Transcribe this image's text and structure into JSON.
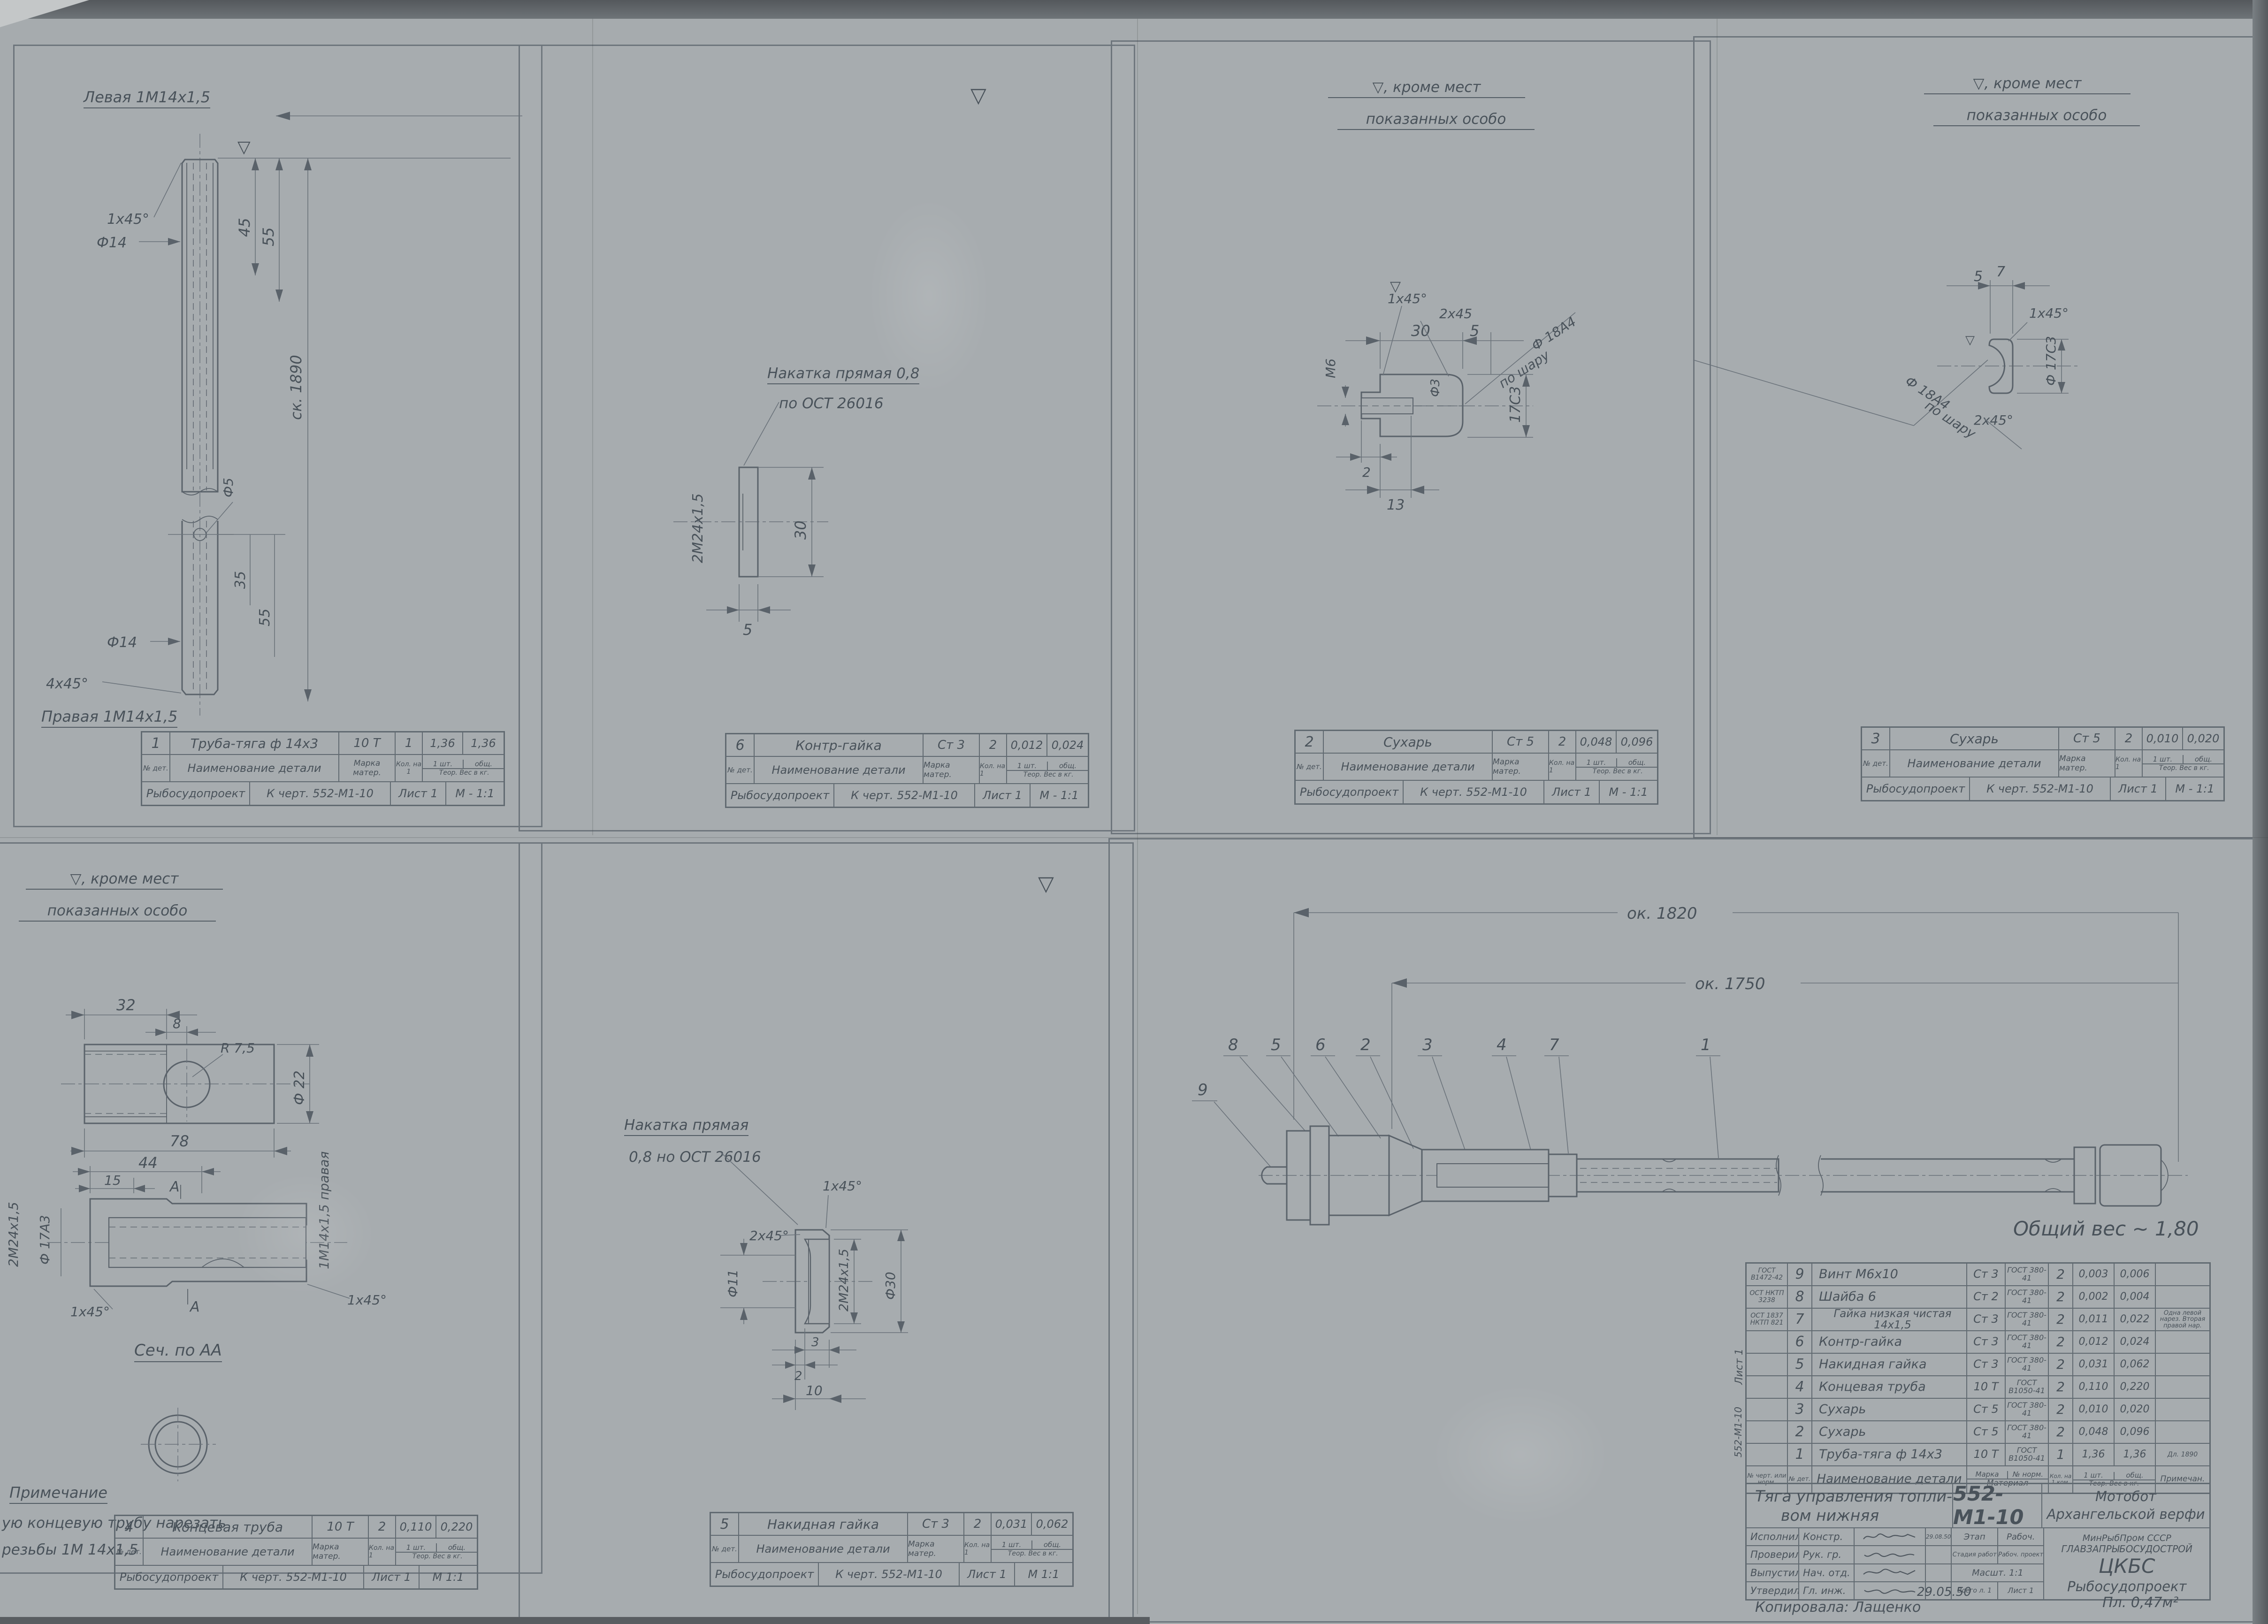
{
  "common": {
    "finish_note_line1": "▽, кроме мест",
    "finish_note_line2": "показанных особо",
    "finish_mark": "▽",
    "mini_labels": {
      "no_det": "№ дет.",
      "name": "Наименование детали",
      "marka": "Марка матер.",
      "qty": "Кол. на 1",
      "w1": "1 шт.",
      "wtot": "общ.",
      "weight": "Теор. Вес в кг.",
      "org": "Рыбосудопроект",
      "chert": "К черт. 552-М1-10",
      "list": "Лист 1"
    }
  },
  "panel1": {
    "top_label": "Левая 1М14х1,5",
    "bottom_label": "Правая 1М14х1,5",
    "dims": {
      "chamfer_top": "1х45°",
      "d14": "Ф14",
      "d5": "Ф5",
      "len45": "45",
      "len55": "55",
      "total": "ск. 1890",
      "d14b": "Ф14",
      "len35": "35",
      "len55b": "55",
      "chamfer_bottom": "4х45°"
    },
    "block": {
      "num": "1",
      "name": "Труба-тяга ф 14х3",
      "mat": "10 Т",
      "qty": "1",
      "w1": "1,36",
      "wt": "1,36",
      "scale": "М - 1:1"
    }
  },
  "panel2": {
    "note1": "Накатка прямая 0,8",
    "note2": "по ОСТ 26016",
    "dims": {
      "thread": "2М24х1,5",
      "h": "30",
      "w": "5"
    },
    "block": {
      "num": "6",
      "name": "Контр-гайка",
      "mat": "Ст 3",
      "qty": "2",
      "w1": "0,012",
      "wt": "0,024",
      "scale": "М - 1:1"
    }
  },
  "panel3": {
    "dims": {
      "w30": "30",
      "w5": "5",
      "ch2": "2х45",
      "ch1": "1х45°",
      "m6": "М6",
      "d3": "Ф3",
      "sphere": "по шару",
      "d18": "Ф 18А4",
      "d17": "17С3",
      "t2": "2",
      "t13": "13"
    },
    "block": {
      "num": "2",
      "name": "Сухарь",
      "mat": "Ст 5",
      "qty": "2",
      "w1": "0,048",
      "wt": "0,096",
      "scale": "М - 1:1"
    }
  },
  "panel4": {
    "dims": {
      "w5": "5",
      "w7": "7",
      "ch1": "1х45°",
      "d18": "Ф 18А4",
      "sphere": "по шару",
      "ch2": "2х45°",
      "d17": "Ф 17С3"
    },
    "block": {
      "num": "3",
      "name": "Сухарь",
      "mat": "Ст 5",
      "qty": "2",
      "w1": "0,010",
      "wt": "0,020",
      "scale": "М - 1:1"
    }
  },
  "panel5": {
    "dims": {
      "w32": "32",
      "w8": "8",
      "r75": "R 7,5",
      "d22": "Ф 22",
      "w78": "78",
      "w44": "44",
      "w15": "15",
      "secA": "А",
      "thread24": "2М24х1,5",
      "d17": "Ф 17А3",
      "ch1l": "1х45°",
      "ch1r": "1х45°",
      "thread14": "1М14х1,5 правая"
    },
    "section_title": "Сеч. по АА",
    "note_title": "Примечание",
    "note1": "ую концевую трубу нарезать",
    "note2": "резьбы 1М 14х1,5",
    "block": {
      "num": "4",
      "name": "Концевая труба",
      "mat": "10 Т",
      "qty": "2",
      "w1": "0,110",
      "wt": "0,220",
      "scale": "М 1:1"
    }
  },
  "panel6": {
    "note1": "Накатка прямая",
    "note2": "0,8 но ОСТ 26016",
    "dims": {
      "ch1": "1х45°",
      "ch2": "2х45°",
      "d11": "Ф11",
      "thread": "2М24х1,5",
      "d30": "Ф30",
      "t3": "3",
      "t2": "2",
      "t10": "10"
    },
    "block": {
      "num": "5",
      "name": "Накидная гайка",
      "mat": "Ст 3",
      "qty": "2",
      "w1": "0,031",
      "wt": "0,062",
      "scale": "М 1:1"
    }
  },
  "assembly": {
    "dim_total": "ок. 1820",
    "dim_inner": "ок. 1750",
    "callouts": [
      "9",
      "8",
      "5",
      "6",
      "2",
      "3",
      "4",
      "7",
      "1"
    ],
    "total_weight": "Общий вес ~ 1,80"
  },
  "parts_list": {
    "headers": {
      "std": "№ черт. или норм.",
      "num": "№ дет.",
      "name": "Наименование детали",
      "marka": "Марка",
      "norm": "№ норм.",
      "material": "Материал",
      "qty": "Кол. на 1 ком.",
      "w1": "1 шт.",
      "wtot": "общ.",
      "weight": "Теор. Вес в кг.",
      "note": "Примечан."
    },
    "side_label_top": "Лист 1",
    "side_label_bottom": "552-М1-10",
    "rows": [
      {
        "std": "ГОСТ В1472-42",
        "num": "9",
        "name": "Винт М6х10",
        "marka": "Ст 3",
        "norm": "ГОСТ 380-41",
        "qty": "2",
        "w1": "0,003",
        "wtot": "0,006",
        "note": ""
      },
      {
        "std": "ОСТ НКТП 3238",
        "num": "8",
        "name": "Шайба 6",
        "marka": "Ст 2",
        "norm": "ГОСТ 380-41",
        "qty": "2",
        "w1": "0,002",
        "wtot": "0,004",
        "note": ""
      },
      {
        "std": "ОСТ 1837 НКТП 821",
        "num": "7",
        "name": "Гайка низкая чистая 14х1,5",
        "marka": "Ст 3",
        "norm": "ГОСТ 380-41",
        "qty": "2",
        "w1": "0,011",
        "wtot": "0,022",
        "note": "Одна левой нарез. Вторая правой нар."
      },
      {
        "std": "",
        "num": "6",
        "name": "Контр-гайка",
        "marka": "Ст 3",
        "norm": "ГОСТ 380-41",
        "qty": "2",
        "w1": "0,012",
        "wtot": "0,024",
        "note": ""
      },
      {
        "std": "",
        "num": "5",
        "name": "Накидная гайка",
        "marka": "Ст 3",
        "norm": "ГОСТ 380-41",
        "qty": "2",
        "w1": "0,031",
        "wtot": "0,062",
        "note": ""
      },
      {
        "std": "",
        "num": "4",
        "name": "Концевая труба",
        "marka": "10 Т",
        "norm": "ГОСТ В1050-41",
        "qty": "2",
        "w1": "0,110",
        "wtot": "0,220",
        "note": ""
      },
      {
        "std": "",
        "num": "3",
        "name": "Сухарь",
        "marka": "Ст 5",
        "norm": "ГОСТ 380-41",
        "qty": "2",
        "w1": "0,010",
        "wtot": "0,020",
        "note": ""
      },
      {
        "std": "",
        "num": "2",
        "name": "Сухарь",
        "marka": "Ст 5",
        "norm": "ГОСТ 380-41",
        "qty": "2",
        "w1": "0,048",
        "wtot": "0,096",
        "note": ""
      },
      {
        "std": "",
        "num": "1",
        "name": "Труба-тяга ф 14х3",
        "marka": "10 Т",
        "norm": "ГОСТ В1050-41",
        "qty": "1",
        "w1": "1,36",
        "wtot": "1,36",
        "note": "Дл. 1890"
      }
    ]
  },
  "title_block": {
    "title_line1": "Тяга управления топли-",
    "title_line2": "вом нижняя",
    "number": "552-М1-10",
    "project_line1": "Мотобот",
    "project_line2": "Архангельской верфи",
    "rows": [
      {
        "role": "Исполнил",
        "who": "Констр.",
        "extra": "29.08.50"
      },
      {
        "role": "Проверил",
        "who": "Рук. гр.",
        "extra": ""
      },
      {
        "role": "Выпустил",
        "who": "Нач. отд.",
        "extra": ""
      },
      {
        "role": "Утвердил",
        "who": "Гл. инж.",
        "extra": ""
      }
    ],
    "stage_label": "Этап",
    "stage_value": "Рабоч.",
    "stage2_label": "Стадия работ",
    "stage2_value": "Рабоч. проект",
    "scale_label": "Масшт. 1:1",
    "sheets_label": "Всего л. 1",
    "sheet_label": "Лист 1",
    "org_line1": "МинРыбПром СССР",
    "org_line2": "ГЛАВЗАПРЫБОСУДОСТРОЙ",
    "org_line3": "ЦКБС",
    "org_line4": "Рыбосудопроект",
    "copied_label": "Копировала: Лащенко",
    "copy_date": "29.05.50",
    "area": "Пл. 0,47м²"
  }
}
